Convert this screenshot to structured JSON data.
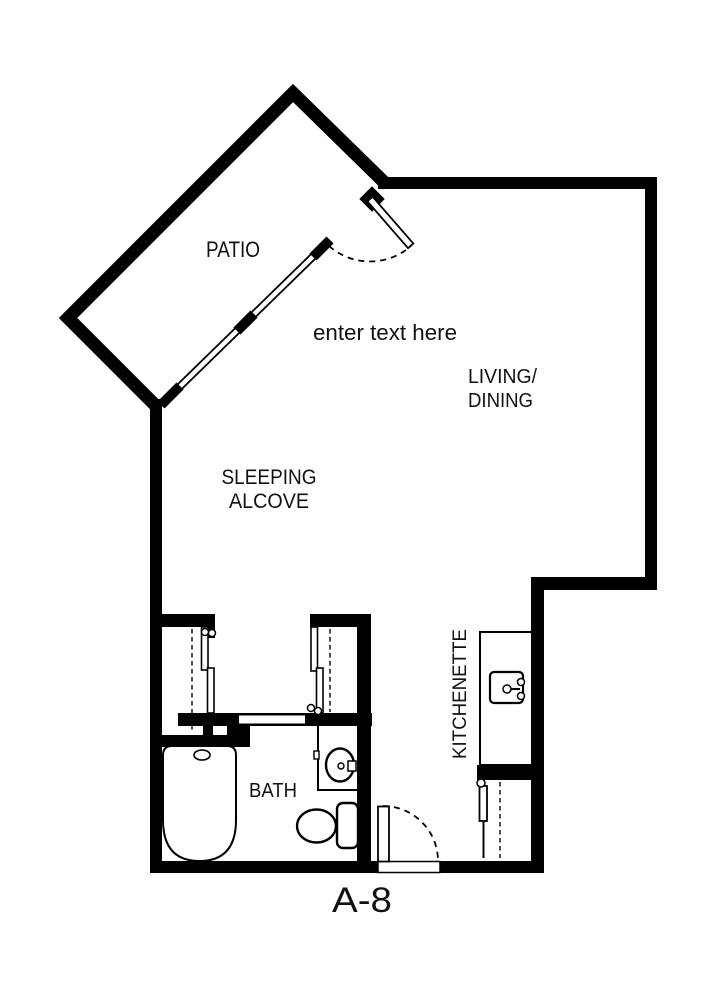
{
  "floor_plan": {
    "unit_label": "A-8",
    "annotation": {
      "placeholder": "enter text here"
    },
    "labels": {
      "patio": "PATIO",
      "living_line1": "LIVING/",
      "living_line2": "DINING",
      "sleeping_line1": "SLEEPING",
      "sleeping_line2": "ALCOVE",
      "bath": "BATH",
      "kitchenette": "KITCHENETTE"
    },
    "colors": {
      "walls": "#000000",
      "floor": "#ffffff",
      "text": "#111111"
    }
  }
}
